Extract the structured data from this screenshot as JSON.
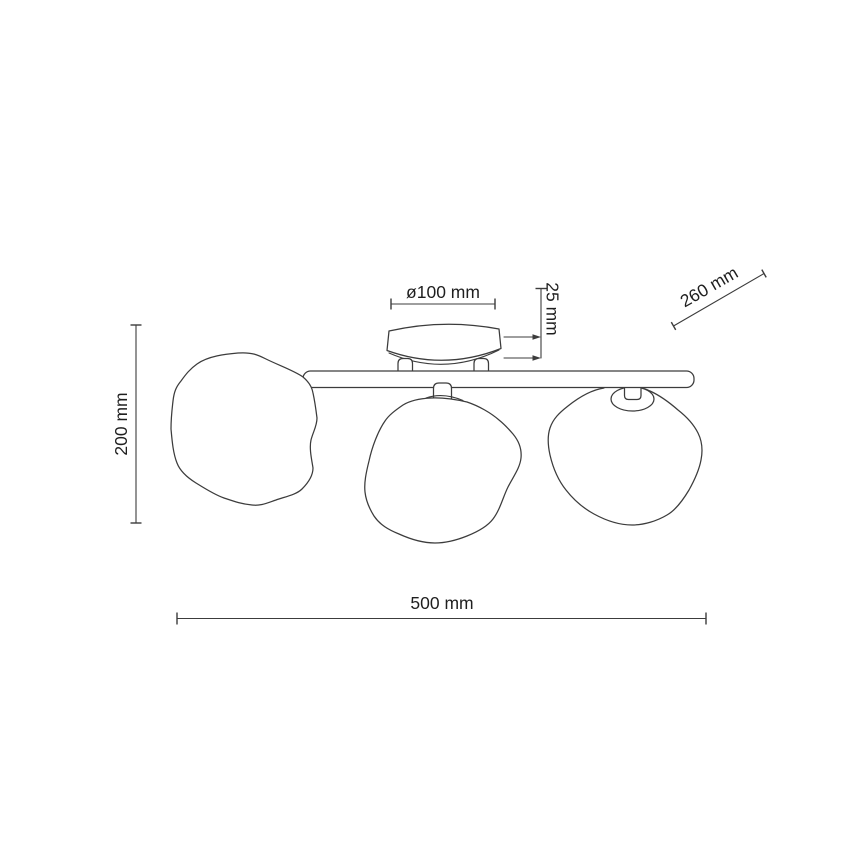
{
  "drawing": {
    "labels": {
      "canopy_diameter": "ø100 mm",
      "canopy_height": "25 mm",
      "shade_width": "260 mm",
      "total_height": "200 mm",
      "total_width": "500 mm"
    },
    "colors": {
      "background": "#ffffff",
      "line": "#3c3c3c",
      "text": "#1f1f1f"
    }
  }
}
